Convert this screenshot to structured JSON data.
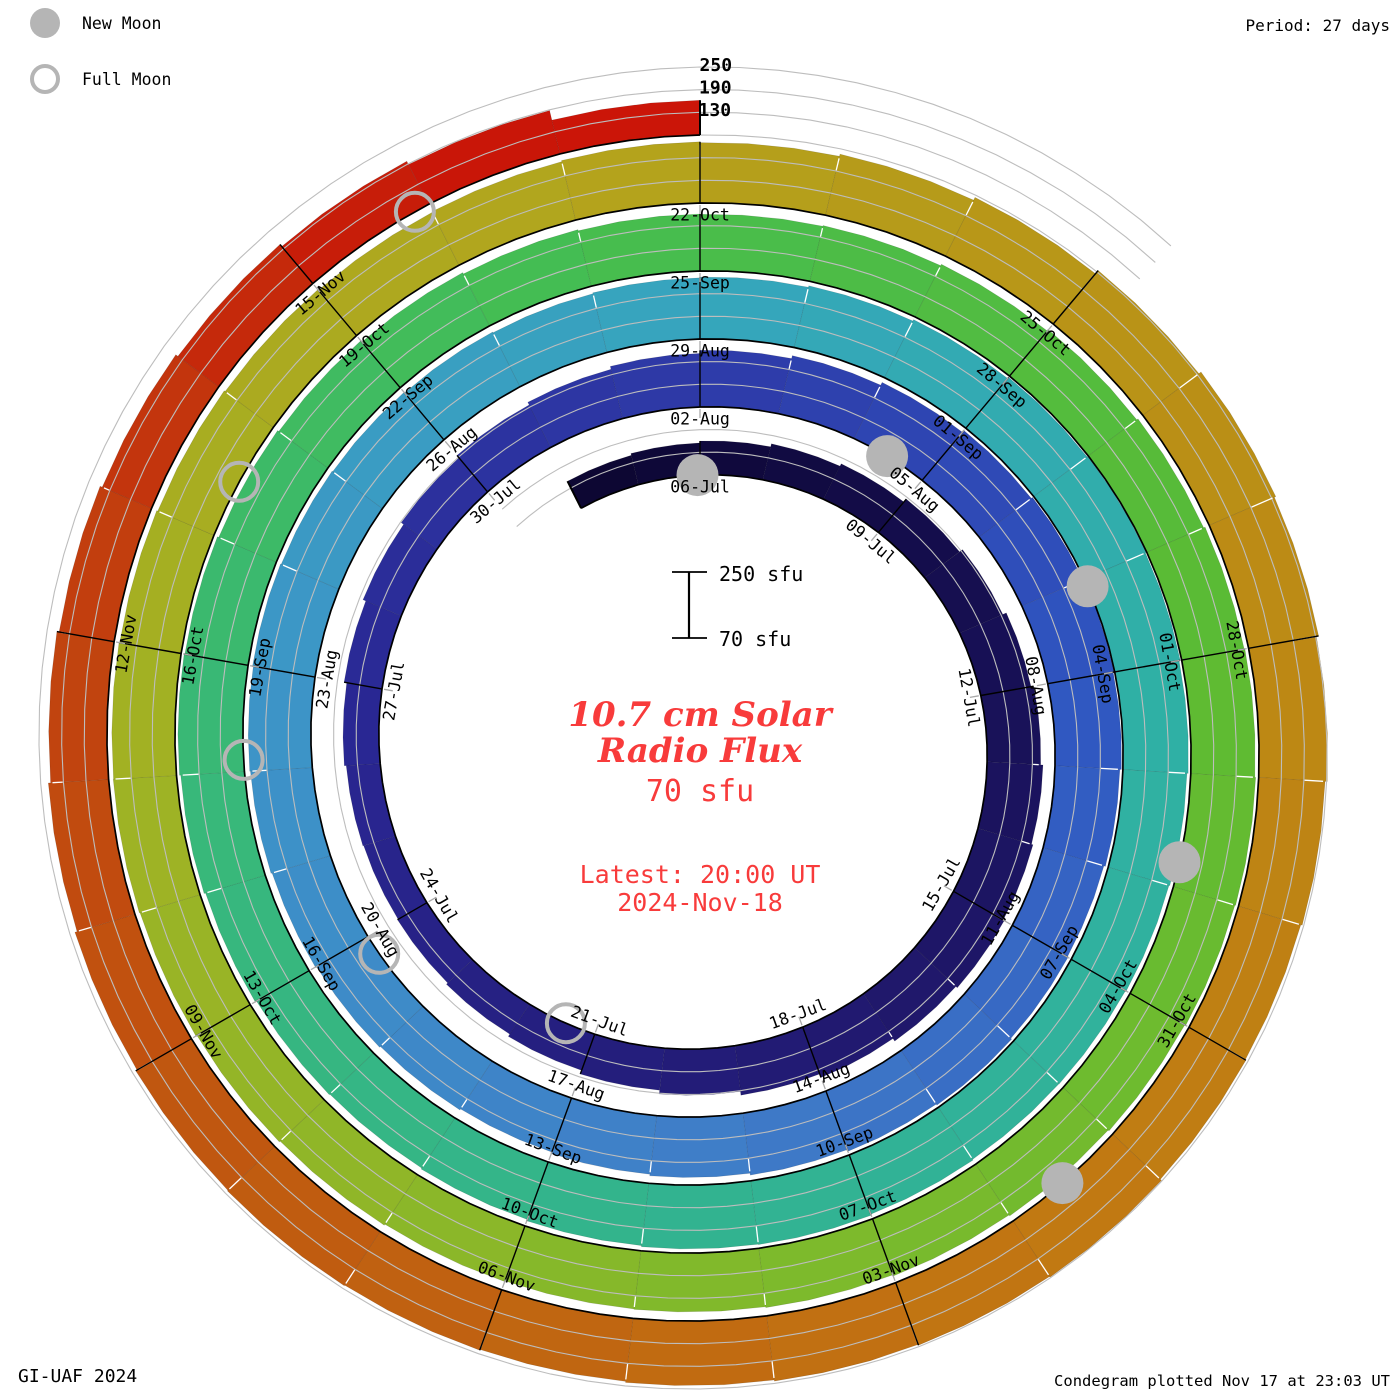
{
  "legend": {
    "new_moon": "New Moon",
    "full_moon": "Full Moon"
  },
  "period_label": "Period: 27 days",
  "credits": {
    "left": "GI-UAF 2024",
    "right": "Condegram plotted Nov 17 at 23:03 UT"
  },
  "center": {
    "title_line1": "10.7 cm Solar",
    "title_line2": "Radio Flux",
    "current_value": "70 sfu",
    "latest_line1": "Latest: 20:00 UT",
    "latest_line2": "2024-Nov-18"
  },
  "scale_bar": {
    "top_label": "250 sfu",
    "bottom_label": "70 sfu"
  },
  "colors": {
    "annotation_red": "#f83b3b",
    "moon_gray": "#b5b5b5",
    "grid_gray": "#bdbdbd",
    "baseline_black": "#000000"
  },
  "chart_data": {
    "type": "bar",
    "layout": "spiral-condegram",
    "title": "10.7 cm Solar Radio Flux",
    "period_days": 27,
    "start_date": "2024-07-04",
    "end_date": "2024-11-18",
    "flux_baseline_sfu": 70,
    "flux_axis_max_sfu": 250,
    "radial_tick_values": [
      130,
      190,
      250
    ],
    "radial_tick_labels": [
      "130",
      "190",
      "250"
    ],
    "date_label_step_days": 3,
    "days": [
      [
        "04-Jul",
        150
      ],
      [
        "05-Jul",
        155
      ],
      [
        "06-Jul",
        160
      ],
      [
        "07-Jul",
        168
      ],
      [
        "08-Jul",
        175
      ],
      [
        "09-Jul",
        185
      ],
      [
        "10-Jul",
        195
      ],
      [
        "11-Jul",
        205
      ],
      [
        "12-Jul",
        212
      ],
      [
        "13-Jul",
        218
      ],
      [
        "14-Jul",
        222
      ],
      [
        "15-Jul",
        225
      ],
      [
        "16-Jul",
        220
      ],
      [
        "17-Jul",
        212
      ],
      [
        "18-Jul",
        202
      ],
      [
        "19-Jul",
        192
      ],
      [
        "20-Jul",
        182
      ],
      [
        "21-Jul",
        172
      ],
      [
        "22-Jul",
        165
      ],
      [
        "23-Jul",
        160
      ],
      [
        "24-Jul",
        158
      ],
      [
        "25-Jul",
        160
      ],
      [
        "26-Jul",
        165
      ],
      [
        "27-Jul",
        172
      ],
      [
        "28-Jul",
        180
      ],
      [
        "29-Jul",
        188
      ],
      [
        "30-Jul",
        196
      ],
      [
        "31-Jul",
        204
      ],
      [
        "01-Aug",
        212
      ],
      [
        "02-Aug",
        220
      ],
      [
        "03-Aug",
        228
      ],
      [
        "04-Aug",
        236
      ],
      [
        "05-Aug",
        242
      ],
      [
        "06-Aug",
        246
      ],
      [
        "07-Aug",
        248
      ],
      [
        "08-Aug",
        246
      ],
      [
        "09-Aug",
        242
      ],
      [
        "10-Aug",
        238
      ],
      [
        "11-Aug",
        240
      ],
      [
        "12-Aug",
        243
      ],
      [
        "13-Aug",
        240
      ],
      [
        "14-Aug",
        235
      ],
      [
        "15-Aug",
        230
      ],
      [
        "16-Aug",
        226
      ],
      [
        "17-Aug",
        222
      ],
      [
        "18-Aug",
        225
      ],
      [
        "19-Aug",
        228
      ],
      [
        "20-Aug",
        231
      ],
      [
        "21-Aug",
        234
      ],
      [
        "22-Aug",
        236
      ],
      [
        "23-Aug",
        238
      ],
      [
        "24-Aug",
        236
      ],
      [
        "25-Aug",
        234
      ],
      [
        "26-Aug",
        232
      ],
      [
        "27-Aug",
        230
      ],
      [
        "28-Aug",
        232
      ],
      [
        "29-Aug",
        234
      ],
      [
        "30-Aug",
        238
      ],
      [
        "31-Aug",
        242
      ],
      [
        "01-Sep",
        246
      ],
      [
        "02-Sep",
        248
      ],
      [
        "03-Sep",
        246
      ],
      [
        "04-Sep",
        243
      ],
      [
        "05-Sep",
        240
      ],
      [
        "06-Sep",
        238
      ],
      [
        "07-Sep",
        236
      ],
      [
        "08-Sep",
        235
      ],
      [
        "09-Sep",
        237
      ],
      [
        "10-Sep",
        240
      ],
      [
        "11-Sep",
        239
      ],
      [
        "12-Sep",
        236
      ],
      [
        "13-Sep",
        232
      ],
      [
        "14-Sep",
        229
      ],
      [
        "15-Sep",
        231
      ],
      [
        "16-Sep",
        235
      ],
      [
        "17-Sep",
        239
      ],
      [
        "18-Sep",
        242
      ],
      [
        "19-Sep",
        240
      ],
      [
        "20-Sep",
        236
      ],
      [
        "21-Sep",
        232
      ],
      [
        "22-Sep",
        228
      ],
      [
        "23-Sep",
        224
      ],
      [
        "24-Sep",
        221
      ],
      [
        "25-Sep",
        220
      ],
      [
        "26-Sep",
        222
      ],
      [
        "27-Sep",
        226
      ],
      [
        "28-Sep",
        230
      ],
      [
        "29-Sep",
        234
      ],
      [
        "30-Sep",
        238
      ],
      [
        "01-Oct",
        240
      ],
      [
        "02-Oct",
        242
      ],
      [
        "03-Oct",
        240
      ],
      [
        "04-Oct",
        237
      ],
      [
        "05-Oct",
        234
      ],
      [
        "06-Oct",
        231
      ],
      [
        "07-Oct",
        228
      ],
      [
        "08-Oct",
        226
      ],
      [
        "09-Oct",
        225
      ],
      [
        "10-Oct",
        227
      ],
      [
        "11-Oct",
        230
      ],
      [
        "12-Oct",
        233
      ],
      [
        "13-Oct",
        236
      ],
      [
        "14-Oct",
        238
      ],
      [
        "15-Oct",
        237
      ],
      [
        "16-Oct",
        235
      ],
      [
        "17-Oct",
        232
      ],
      [
        "18-Oct",
        229
      ],
      [
        "19-Oct",
        227
      ],
      [
        "20-Oct",
        229
      ],
      [
        "21-Oct",
        232
      ],
      [
        "22-Oct",
        230
      ],
      [
        "23-Oct",
        236
      ],
      [
        "24-Oct",
        244
      ],
      [
        "25-Oct",
        255
      ],
      [
        "26-Oct",
        262
      ],
      [
        "27-Oct",
        258
      ],
      [
        "28-Oct",
        252
      ],
      [
        "29-Oct",
        246
      ],
      [
        "30-Oct",
        242
      ],
      [
        "31-Oct",
        244
      ],
      [
        "01-Nov",
        248
      ],
      [
        "02-Nov",
        246
      ],
      [
        "03-Nov",
        244
      ],
      [
        "04-Nov",
        241
      ],
      [
        "05-Nov",
        238
      ],
      [
        "06-Nov",
        240
      ],
      [
        "07-Nov",
        242
      ],
      [
        "08-Nov",
        240
      ],
      [
        "09-Nov",
        236
      ],
      [
        "10-Nov",
        230
      ],
      [
        "11-Nov",
        224
      ],
      [
        "12-Nov",
        218
      ],
      [
        "13-Nov",
        212
      ],
      [
        "14-Nov",
        205
      ],
      [
        "15-Nov",
        198
      ],
      [
        "16-Nov",
        188
      ],
      [
        "17-Nov",
        162
      ],
      [
        "18-Nov",
        70
      ]
    ],
    "moons": [
      {
        "date": "05-Jul",
        "type": "new",
        "day": -0.04
      },
      {
        "date": "21-Jul",
        "type": "full",
        "day": 15.43
      },
      {
        "date": "04-Aug",
        "type": "new",
        "day": 29.47
      },
      {
        "date": "19-Aug",
        "type": "full",
        "day": 44.77
      },
      {
        "date": "03-Sep",
        "type": "new",
        "day": 59.08
      },
      {
        "date": "18-Sep",
        "type": "full",
        "day": 74.11
      },
      {
        "date": "02-Oct",
        "type": "new",
        "day": 88.78
      },
      {
        "date": "17-Oct",
        "type": "full",
        "day": 103.48
      },
      {
        "date": "01-Nov",
        "type": "new",
        "day": 118.53
      },
      {
        "date": "15-Nov",
        "type": "full",
        "day": 132.89
      }
    ],
    "colormap": [
      [
        -2,
        "#0c0630"
      ],
      [
        4,
        "#150e4e"
      ],
      [
        12,
        "#221a72"
      ],
      [
        20,
        "#292691"
      ],
      [
        27,
        "#2e3aa8"
      ],
      [
        33,
        "#2f55c0"
      ],
      [
        40,
        "#3f7cc8"
      ],
      [
        47,
        "#3d93c8"
      ],
      [
        54,
        "#36a5bd"
      ],
      [
        60,
        "#2fb0a6"
      ],
      [
        67,
        "#32b392"
      ],
      [
        74,
        "#38b878"
      ],
      [
        80,
        "#45bd50"
      ],
      [
        87,
        "#5cbb33"
      ],
      [
        94,
        "#7fba2b"
      ],
      [
        101,
        "#a0b224"
      ],
      [
        107,
        "#b3a51d"
      ],
      [
        113,
        "#bb8d15"
      ],
      [
        119,
        "#c17712"
      ],
      [
        125,
        "#c05a10"
      ],
      [
        130,
        "#c23b0e"
      ],
      [
        133,
        "#c81708"
      ],
      [
        135,
        "#cc1408"
      ]
    ]
  }
}
